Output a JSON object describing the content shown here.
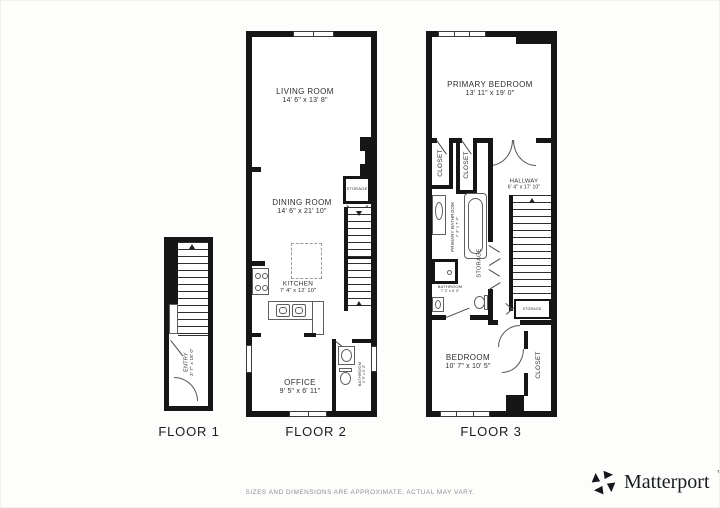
{
  "meta": {
    "wall_color": "#161616",
    "text_color": "#2d2d2d",
    "muted_color": "#8f8f8f"
  },
  "floor1": {
    "label": "FLOOR 1",
    "entry": {
      "name": "ENTRY",
      "dims": "3' 7\" x 18' 0\""
    }
  },
  "floor2": {
    "label": "FLOOR 2",
    "living": {
      "name": "LIVING ROOM",
      "dims": "14' 6\" x 13' 8\""
    },
    "dining": {
      "name": "DINING ROOM",
      "dims": "14' 6\" x 21' 10\""
    },
    "kitchen": {
      "name": "KITCHEN",
      "dims": "7' 4\" x 12' 10\""
    },
    "office": {
      "name": "OFFICE",
      "dims": "9' 5\" x 6' 11\""
    },
    "bathroom": {
      "name": "BATHROOM",
      "dims": "4' 9\" x 5' 3\""
    },
    "storage": {
      "name": "STORAGE"
    }
  },
  "floor3": {
    "label": "FLOOR 3",
    "primary_bedroom": {
      "name": "PRIMARY BEDROOM",
      "dims": "13' 11\" x 19' 0\""
    },
    "closet_a": {
      "name": "CLOSET"
    },
    "closet_b": {
      "name": "CLOSET"
    },
    "hallway": {
      "name": "HALLWAY",
      "dims": "6' 4\" x 17' 10\""
    },
    "primary_bathroom": {
      "name": "PRIMARY BATHROOM",
      "dims": "7' 3\" x 7' 4\""
    },
    "storage": {
      "name": "STORAGE"
    },
    "bathroom": {
      "name": "BATHROOM",
      "dims": "7' 2\" x 6' 3\""
    },
    "storage_small": {
      "name": "STORAGE"
    },
    "bedroom": {
      "name": "BEDROOM",
      "dims": "10' 7\" x 10' 5\""
    },
    "closet_c": {
      "name": "CLOSET"
    }
  },
  "footer": {
    "disclaimer": "SIZES AND DIMENSIONS ARE APPROXIMATE, ACTUAL MAY VARY.",
    "brand": "Matterport",
    "brand_mark": "™"
  }
}
